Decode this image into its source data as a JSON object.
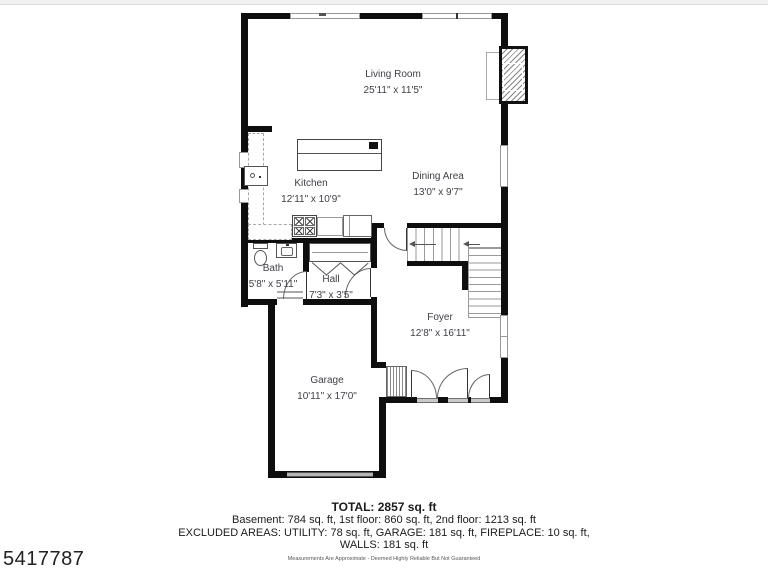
{
  "page": {
    "photo_id": "5417787"
  },
  "rooms": [
    {
      "name": "Living Room",
      "dims": "25'11\" x 11'5\""
    },
    {
      "name": "Kitchen",
      "dims": "12'11\" x 10'9\""
    },
    {
      "name": "Dining Area",
      "dims": "13'0\" x 9'7\""
    },
    {
      "name": "Bath",
      "dims": "5'8\" x 5'11\""
    },
    {
      "name": "Hall",
      "dims": "7'3\" x 3'5\""
    },
    {
      "name": "Foyer",
      "dims": "12'8\" x 16'11\""
    },
    {
      "name": "Garage",
      "dims": "10'11\" x 17'0\""
    }
  ],
  "summary": {
    "total": "TOTAL: 2857 sq. ft",
    "floors": "Basement: 784 sq. ft, 1st floor: 860 sq. ft, 2nd floor: 1213 sq. ft",
    "excluded_line1": "EXCLUDED AREAS: UTILITY: 78 sq. ft, GARAGE: 181 sq. ft, FIREPLACE: 10 sq. ft,",
    "excluded_line2": "WALLS: 181 sq. ft",
    "disclaimer": "Measurements Are Approximate - Deemed Highly Reliable But Not Guaranteed"
  },
  "colors": {
    "wall": "#0e0e0e",
    "label_text": "#3e3e46",
    "window_fill": "#ffffff",
    "threshold": "#c9c9c9",
    "garage_door": "#b5b5b5"
  }
}
